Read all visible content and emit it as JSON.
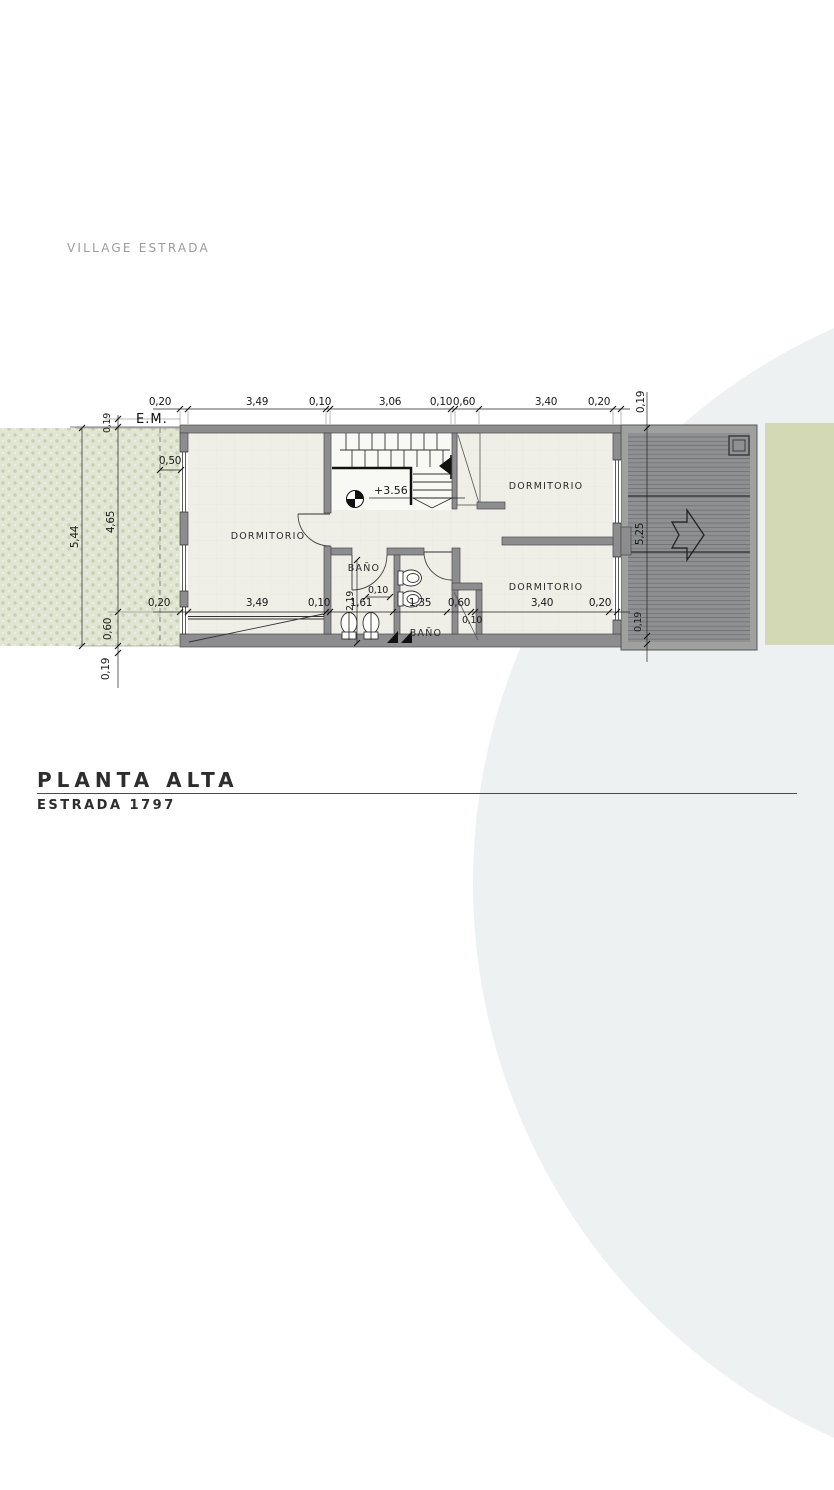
{
  "header": {
    "project_label": "VILLAGE ESTRADA"
  },
  "title_block": {
    "title": "PLANTA ALTA",
    "subtitle": "ESTRADA 1797"
  },
  "plan": {
    "em_label": "E.M.",
    "level_marker": "+3.56",
    "rooms": {
      "dormitorio_left": "DORMITORIO",
      "dormitorio_top_right": "DORMITORIO",
      "dormitorio_bottom_right": "DORMITORIO",
      "banio_upper": "BAÑO",
      "banio_lower": "BAÑO"
    },
    "dims": {
      "top": {
        "w1": "0,20",
        "w2": "3,49",
        "w3": "0,10",
        "w4": "3,06",
        "w5": "0,10",
        "w6": "0,60",
        "w7": "3,40",
        "w8": "0,20",
        "overhang": "0,19"
      },
      "bottom": {
        "w1": "0,20",
        "w2": "3,49",
        "w3": "0,10",
        "w4": "1,61",
        "w5": "1,35",
        "w6": "0,60",
        "w7": "3,40",
        "w8": "0,20",
        "small_a": "0,10",
        "small_b": "0,10",
        "banio_depth": "2,19"
      },
      "left": {
        "top_offset": "0,19",
        "total": "5,44",
        "interior": "4,65",
        "setback": "0,50",
        "bottom_a": "0,60",
        "bottom_b": "0,19"
      },
      "right": {
        "top_offset": "0,19",
        "deck_height": "5,25",
        "bottom_offset": "0,19"
      }
    }
  },
  "colors": {
    "wall": "#8d8d8f",
    "floor": "#efeee7",
    "stair_floor": "#f8f8f5",
    "deck": "#8e9092",
    "deck_frame": "#9fa19f",
    "garden": "#e1e5d3",
    "garden_motif": "#c7d0b2",
    "side_band": "#d3d8b5",
    "circle": "#eef1f1",
    "ink": "#1a1a1a",
    "muted_label": "#9b9b9b"
  }
}
